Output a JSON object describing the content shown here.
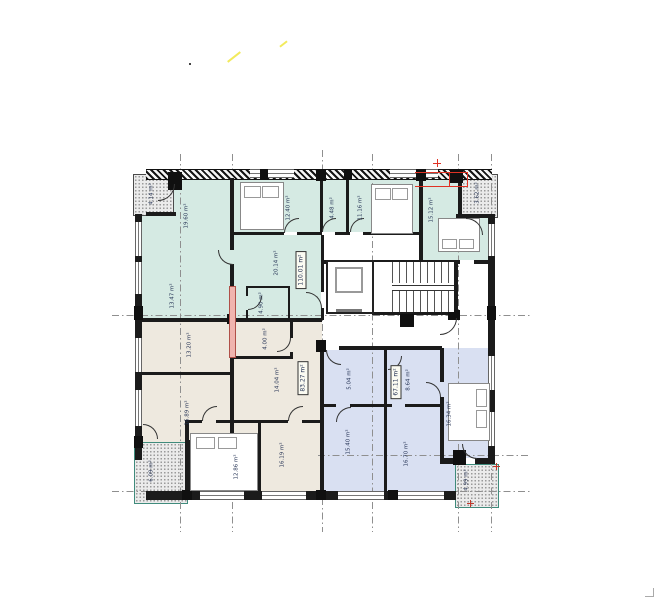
{
  "plan": {
    "sheet": "residential floor plan",
    "colors": {
      "unit_a_fill": "#d5eae3",
      "unit_b_fill": "#eee9df",
      "unit_c_fill": "#d9e0f2",
      "wall": "#1b1b1b",
      "highlight_red": "#e03224",
      "grid_line": "#8f8f8f",
      "label_text": "#1f2d50",
      "pink_wall": "#f0b4ae"
    },
    "units": {
      "a": {
        "name": "apartment-top",
        "total_area": "110.01 m²",
        "rooms": [
          {
            "id": "living-room",
            "area": "19.60 m²"
          },
          {
            "id": "room-lower-left",
            "area": "13.47 m²"
          },
          {
            "id": "bedroom-1",
            "area": "12.40 m²"
          },
          {
            "id": "closet",
            "area": "4.48 m²"
          },
          {
            "id": "bedroom-2",
            "area": "11.16 m²"
          },
          {
            "id": "bedroom-3",
            "area": "15.12 m²"
          },
          {
            "id": "hall",
            "area": "20.14 m²"
          },
          {
            "id": "bathroom",
            "area": "4.90 m²"
          }
        ]
      },
      "b": {
        "name": "apartment-bottom-left",
        "total_area": "83.27 m²",
        "rooms": [
          {
            "id": "room-1",
            "area": "13.20 m²"
          },
          {
            "id": "storage",
            "area": "4.00 m²"
          },
          {
            "id": "hall",
            "area": "14.04 m²"
          },
          {
            "id": "living-room",
            "area": "16.89 m²"
          },
          {
            "id": "bedroom",
            "area": "12.86 m²"
          },
          {
            "id": "room-2",
            "area": "16.19 m²"
          }
        ]
      },
      "c": {
        "name": "apartment-bottom-right",
        "total_area": "67.11 m²",
        "rooms": [
          {
            "id": "bathroom",
            "area": "5.04 m²"
          },
          {
            "id": "kitchen",
            "area": "8.64 m²"
          },
          {
            "id": "bedroom",
            "area": "16.34 m²"
          },
          {
            "id": "room-1",
            "area": "15.40 m²"
          },
          {
            "id": "room-2",
            "area": "16.70 m²"
          }
        ]
      }
    },
    "balconies": [
      {
        "id": "top-left",
        "area": "4.14 m²"
      },
      {
        "id": "top-right",
        "area": "3.62 m²"
      },
      {
        "id": "bottom-left",
        "area": "6.09 m²"
      },
      {
        "id": "bottom-right",
        "area": "4.99 m²"
      }
    ]
  }
}
